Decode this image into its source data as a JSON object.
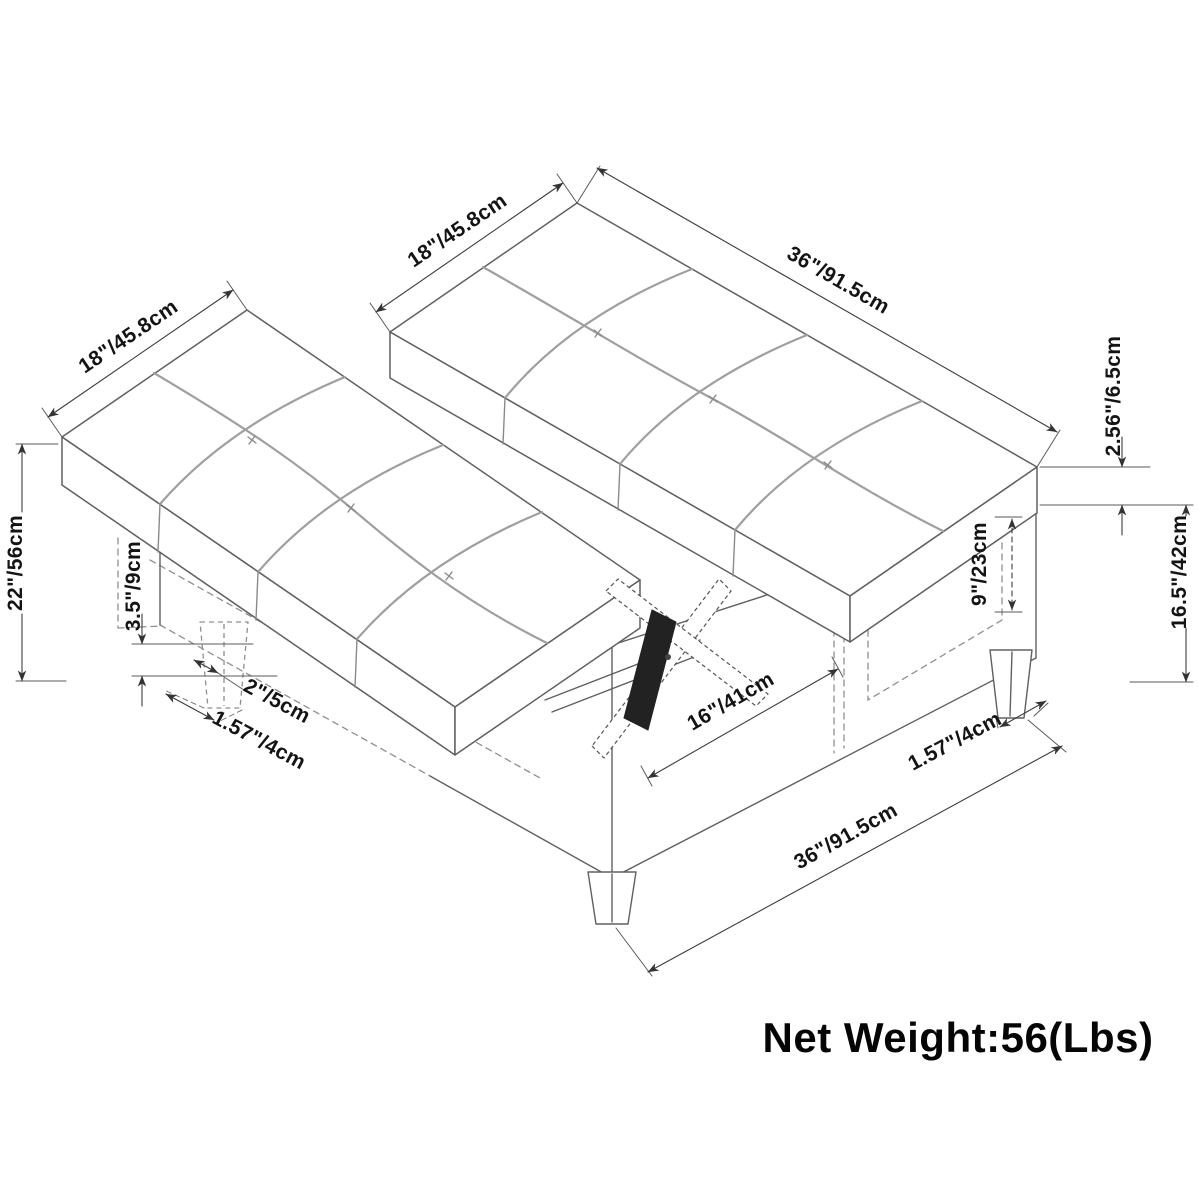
{
  "diagram": {
    "dimensions": {
      "left_cushion_width": "18\"/45.8cm",
      "right_cushion_width": "18\"/45.8cm",
      "cushion_length": "36\"/91.5cm",
      "cushion_thickness": "2.56\"/6.5cm",
      "base_height": "16.5\"/42cm",
      "side_cubby_height": "9\"/23cm",
      "open_height": "22\"/56cm",
      "leg_height": "3.5\"/9cm",
      "leg_top_width": "2\"/5cm",
      "leg_bottom_width_left": "1.57\"/4cm",
      "storage_opening_length": "16\"/41cm",
      "leg_bottom_width_right": "1.57\"/4cm",
      "base_length": "36\"/91.5cm"
    },
    "net_weight": "Net Weight:56(Lbs)"
  }
}
